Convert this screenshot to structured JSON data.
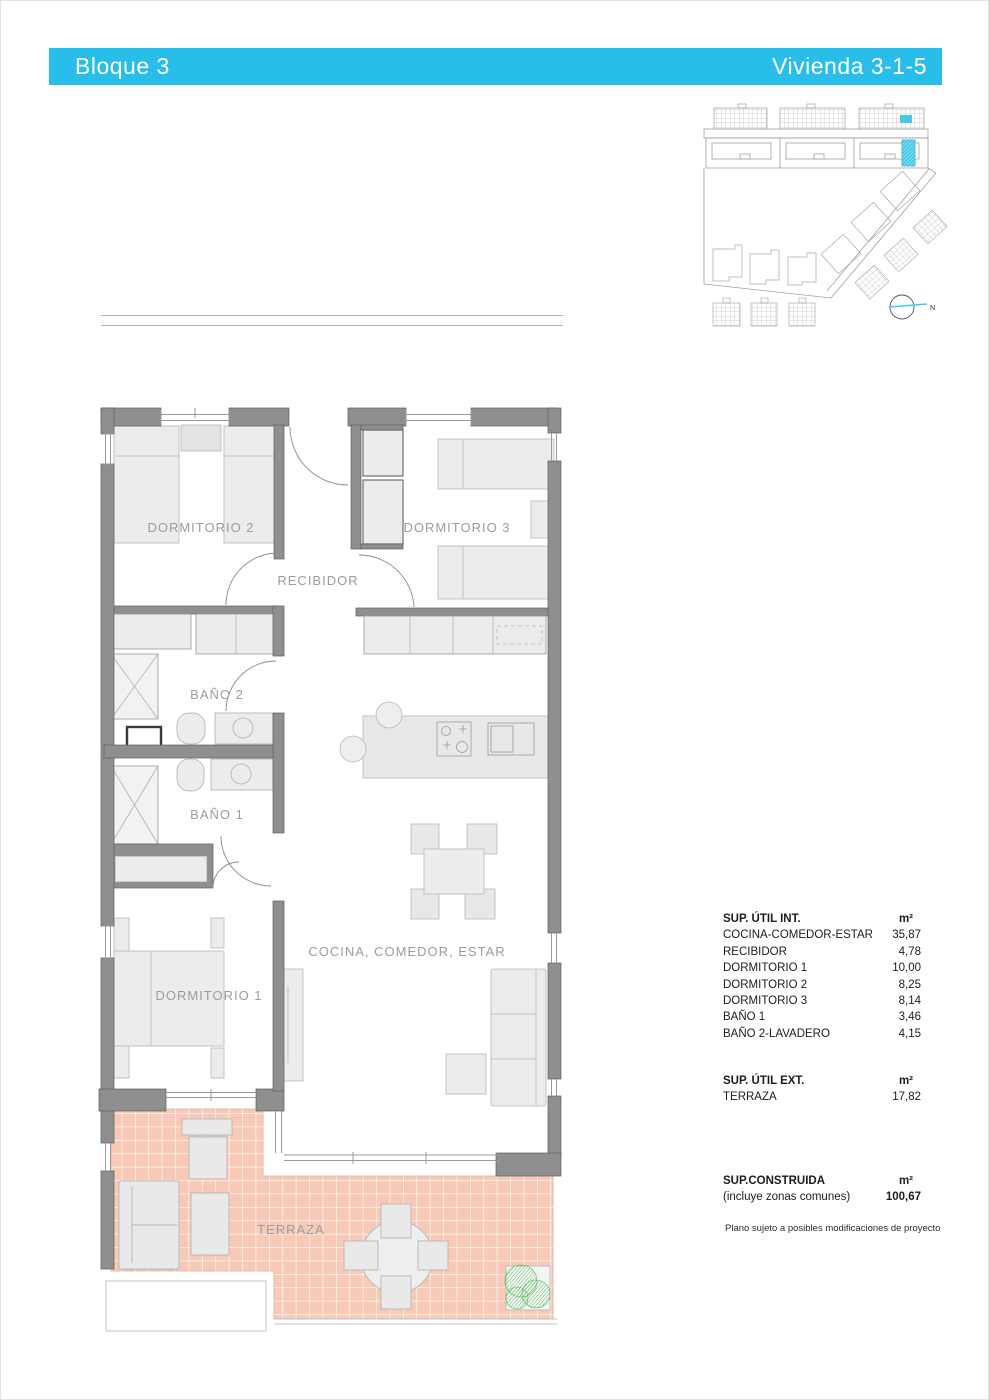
{
  "header": {
    "left": "Bloque 3",
    "right": "Vivienda 3-1-5"
  },
  "colors": {
    "header_bg": "#29bee9",
    "highlight_cyan": "#45c8e8",
    "terrace_pink": "#f7c9b6",
    "plant_green": "#4db84d",
    "wall_gray": "#8f8f8f"
  },
  "site_plan": {
    "north_label": "N"
  },
  "floor_plan": {
    "rooms": {
      "dormitorio2": "DORMITORIO 2",
      "dormitorio3": "DORMITORIO 3",
      "recibidor": "RECIBIDOR",
      "bano2": "BAÑO 2",
      "bano1": "BAÑO 1",
      "dormitorio1": "DORMITORIO 1",
      "cocina": "COCINA, COMEDOR, ESTAR",
      "terraza": "TERRAZA"
    }
  },
  "areas_int": {
    "title": "SUP. ÚTIL INT.",
    "unit": "m²",
    "rows": [
      {
        "label": "COCINA-COMEDOR-ESTAR",
        "value": "35,87"
      },
      {
        "label": "RECIBIDOR",
        "value": "4,78"
      },
      {
        "label": "DORMITORIO 1",
        "value": "10,00"
      },
      {
        "label": "DORMITORIO 2",
        "value": "8,25"
      },
      {
        "label": "DORMITORIO 3",
        "value": "8,14"
      },
      {
        "label": "BAÑO 1",
        "value": "3,46"
      },
      {
        "label": "BAÑO 2-LAVADERO",
        "value": "4,15"
      }
    ]
  },
  "areas_ext": {
    "title": "SUP. ÚTIL EXT.",
    "unit": "m²",
    "rows": [
      {
        "label": "TERRAZA",
        "value": "17,82"
      }
    ]
  },
  "constructed": {
    "title": "SUP.CONSTRUIDA",
    "subtitle": "(incluye zonas comunes)",
    "unit": "m²",
    "value": "100,67"
  },
  "disclaimer": "Plano sujeto a posibles modificaciones de proyecto"
}
